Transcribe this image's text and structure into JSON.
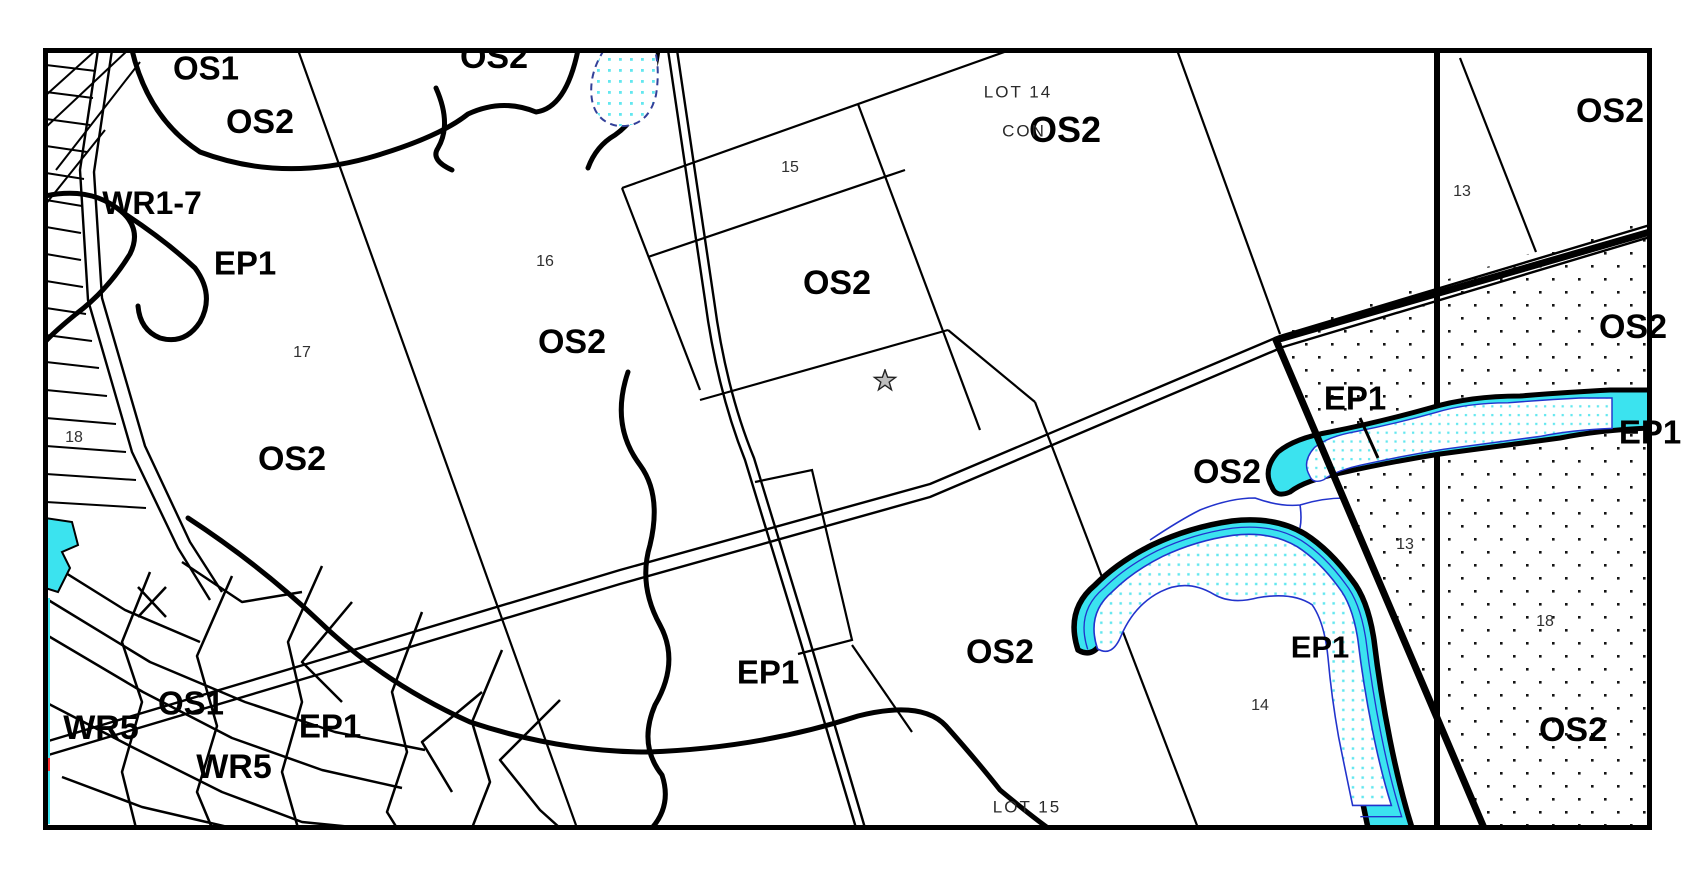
{
  "map": {
    "description": "zoning-schedule-map",
    "zone_labels": [
      {
        "text": "OS1",
        "x": 206,
        "y": 68,
        "size": 33
      },
      {
        "text": "OS2",
        "x": 260,
        "y": 122,
        "size": 34
      },
      {
        "text": "OS2",
        "x": 494,
        "y": 57,
        "size": 34
      },
      {
        "text": "WR1-7",
        "x": 152,
        "y": 203,
        "size": 32
      },
      {
        "text": "EP1",
        "x": 245,
        "y": 263,
        "size": 33
      },
      {
        "text": "OS2",
        "x": 572,
        "y": 342,
        "size": 34
      },
      {
        "text": "OS2",
        "x": 292,
        "y": 459,
        "size": 34
      },
      {
        "text": "OS2",
        "x": 837,
        "y": 283,
        "size": 34
      },
      {
        "text": "OS2",
        "x": 1065,
        "y": 130,
        "size": 36
      },
      {
        "text": "OS2",
        "x": 1610,
        "y": 111,
        "size": 34
      },
      {
        "text": "OS2",
        "x": 1633,
        "y": 327,
        "size": 34
      },
      {
        "text": "EP1",
        "x": 1355,
        "y": 398,
        "size": 33
      },
      {
        "text": "EP1",
        "x": 1650,
        "y": 432,
        "size": 33
      },
      {
        "text": "OS2",
        "x": 1227,
        "y": 472,
        "size": 34
      },
      {
        "text": "OS2",
        "x": 1000,
        "y": 652,
        "size": 34
      },
      {
        "text": "EP1",
        "x": 768,
        "y": 672,
        "size": 33
      },
      {
        "text": "EP1",
        "x": 1320,
        "y": 647,
        "size": 31
      },
      {
        "text": "OS2",
        "x": 1573,
        "y": 730,
        "size": 34
      },
      {
        "text": "OS1",
        "x": 191,
        "y": 703,
        "size": 33
      },
      {
        "text": "WR5",
        "x": 101,
        "y": 728,
        "size": 34
      },
      {
        "text": "EP1",
        "x": 330,
        "y": 726,
        "size": 33
      },
      {
        "text": "WR5",
        "x": 234,
        "y": 767,
        "size": 34
      }
    ],
    "lot_texts": [
      {
        "text": "LOT 14",
        "x": 1018,
        "y": 92
      },
      {
        "text": "CON",
        "x": 1024,
        "y": 131
      },
      {
        "text": "LOT 15",
        "x": 1027,
        "y": 807
      }
    ],
    "parcel_numbers": [
      {
        "text": "15",
        "x": 790,
        "y": 168
      },
      {
        "text": "16",
        "x": 545,
        "y": 262
      },
      {
        "text": "17",
        "x": 302,
        "y": 353
      },
      {
        "text": "18",
        "x": 74,
        "y": 438
      },
      {
        "text": "13",
        "x": 1462,
        "y": 192
      },
      {
        "text": "13",
        "x": 1405,
        "y": 545
      },
      {
        "text": "18",
        "x": 1545,
        "y": 622
      },
      {
        "text": "14",
        "x": 1260,
        "y": 706
      }
    ],
    "markers": {
      "star": {
        "symbol": "star",
        "x": 885,
        "y": 381
      }
    },
    "colors": {
      "water": "#3BE3EF",
      "water_dot": "#62E7EF",
      "stream_line": "#2233CC",
      "dash_outline": "#334099",
      "stipple": "#141414",
      "star_fill": "#BEBEBE",
      "red_tick": "#FF2B2B",
      "line": "#000000"
    }
  }
}
